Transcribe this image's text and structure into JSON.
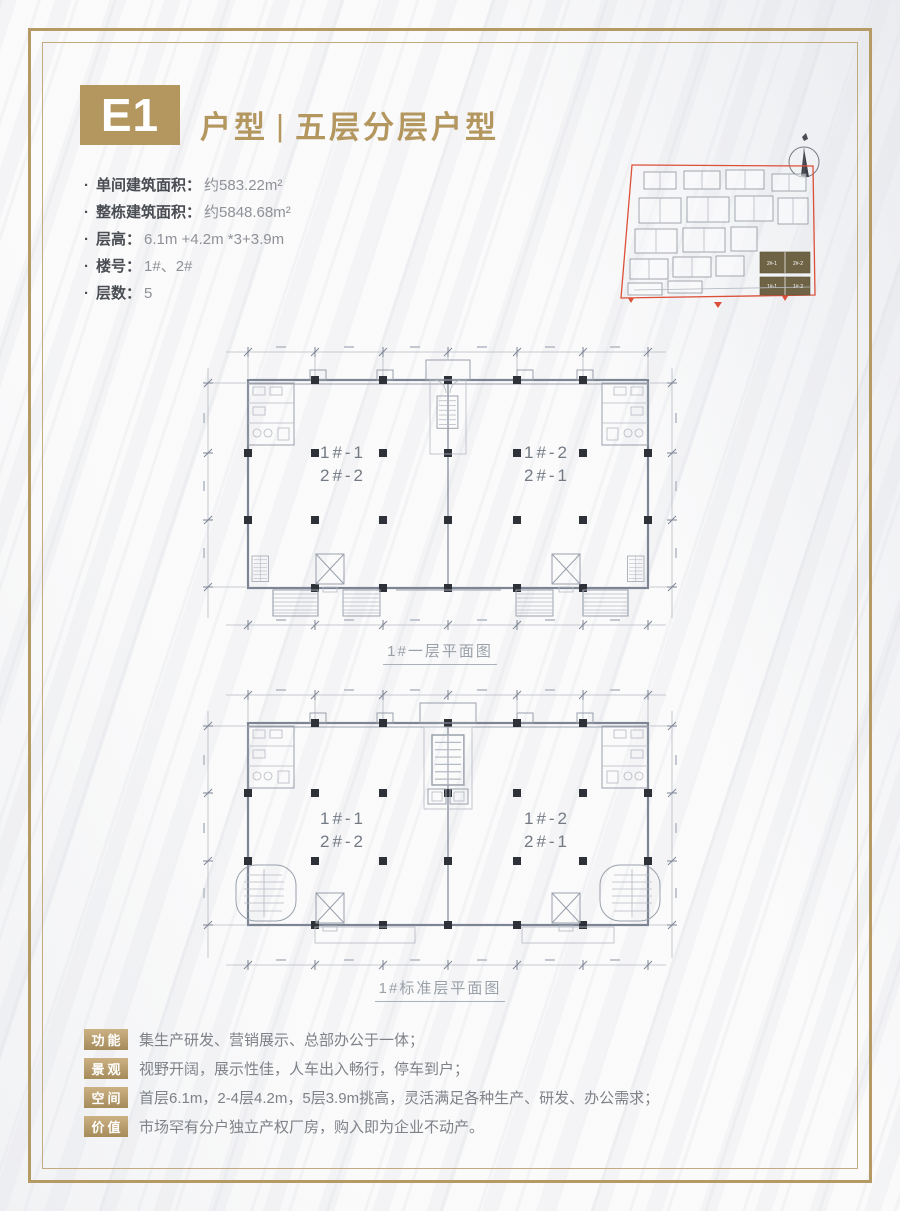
{
  "header": {
    "code": "E1",
    "title_left": "户型",
    "separator": "|",
    "title_right": "五层分层户型"
  },
  "specs": [
    {
      "bullet": "·",
      "label": "单间建筑面积：",
      "value": "约583.22m²"
    },
    {
      "bullet": "·",
      "label": "整栋建筑面积：",
      "value": "约5848.68m²"
    },
    {
      "bullet": "·",
      "label": "层高：",
      "value": "6.1m +4.2m *3+3.9m"
    },
    {
      "bullet": "·",
      "label": "楼号：",
      "value": "1#、2#"
    },
    {
      "bullet": "·",
      "label": "层数：",
      "value": "5"
    }
  ],
  "site_map": {
    "building2": {
      "left": "2#-1",
      "right": "2#-2"
    },
    "building1": {
      "left": "1#-1",
      "right": "1#-2"
    }
  },
  "plans": [
    {
      "caption": "1#一层平面图",
      "left_line1": "1#-1",
      "left_line2": "2#-2",
      "right_line1": "1#-2",
      "right_line2": "2#-1"
    },
    {
      "caption": "1#标准层平面图",
      "left_line1": "1#-1",
      "left_line2": "2#-2",
      "right_line1": "1#-2",
      "right_line2": "2#-1"
    }
  ],
  "features": [
    {
      "badge": "功能",
      "text": "集生产研发、营销展示、总部办公于一体；"
    },
    {
      "badge": "景观",
      "text": "视野开阔，展示性佳，人车出入畅行，停车到户；"
    },
    {
      "badge": "空间",
      "text": "首层6.1m，2-4层4.2m，5层3.9m挑高，灵活满足各种生产、研发、办公需求；"
    },
    {
      "badge": "价值",
      "text": "市场罕有分户独立产权厂房，购入即为企业不动产。"
    }
  ],
  "colors": {
    "gold": "#b3975f",
    "red": "#dc4f39",
    "plan_line": "#7d8493",
    "highlight_block": "#6f6345"
  }
}
